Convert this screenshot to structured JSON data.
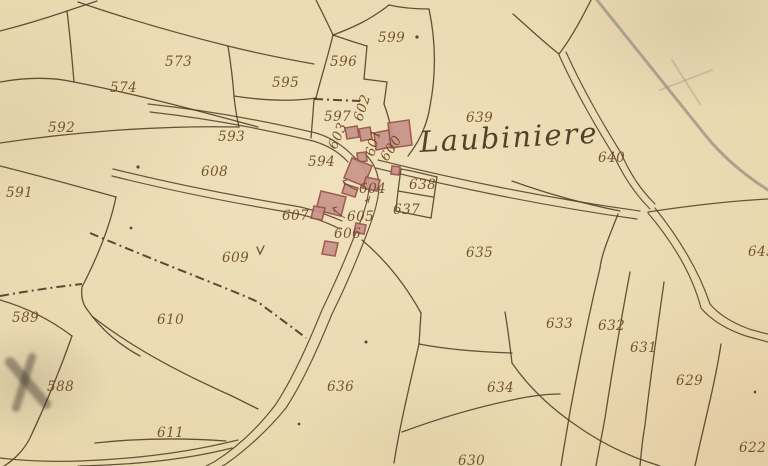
{
  "map": {
    "place_name": "Laubiniere",
    "place_label": {
      "x": 420,
      "y": 152,
      "rot": -3
    },
    "parcel_labels": [
      {
        "text": "573",
        "x": 165,
        "y": 66,
        "rot": 0
      },
      {
        "text": "574",
        "x": 110,
        "y": 92,
        "rot": 0
      },
      {
        "text": "592",
        "x": 48,
        "y": 132,
        "rot": 0
      },
      {
        "text": "593",
        "x": 218,
        "y": 141,
        "rot": 0
      },
      {
        "text": "591",
        "x": 6,
        "y": 197,
        "rot": 0
      },
      {
        "text": "595",
        "x": 272,
        "y": 87,
        "rot": 0
      },
      {
        "text": "596",
        "x": 330,
        "y": 66,
        "rot": 0
      },
      {
        "text": "599",
        "x": 378,
        "y": 42,
        "rot": 0
      },
      {
        "text": "597",
        "x": 324,
        "y": 121,
        "rot": 0
      },
      {
        "text": "639",
        "x": 466,
        "y": 122,
        "rot": 0
      },
      {
        "text": "640",
        "x": 598,
        "y": 162,
        "rot": 0
      },
      {
        "text": "608",
        "x": 201,
        "y": 176,
        "rot": 0
      },
      {
        "text": "594",
        "x": 308,
        "y": 166,
        "rot": 0
      },
      {
        "text": "602",
        "x": 362,
        "y": 122,
        "rot": -72
      },
      {
        "text": "603",
        "x": 336,
        "y": 150,
        "rot": -66
      },
      {
        "text": "601",
        "x": 374,
        "y": 157,
        "rot": -75
      },
      {
        "text": "600",
        "x": 387,
        "y": 162,
        "rot": -56
      },
      {
        "text": "604",
        "x": 359,
        "y": 193,
        "rot": 0
      },
      {
        "text": "638",
        "x": 409,
        "y": 189,
        "rot": 0
      },
      {
        "text": "607",
        "x": 282,
        "y": 220,
        "rot": 0
      },
      {
        "text": "605",
        "x": 347,
        "y": 221,
        "rot": 0
      },
      {
        "text": "637",
        "x": 393,
        "y": 214,
        "rot": 0
      },
      {
        "text": "606",
        "x": 334,
        "y": 238,
        "rot": 0
      },
      {
        "text": "609",
        "x": 222,
        "y": 262,
        "rot": 0
      },
      {
        "text": "635",
        "x": 466,
        "y": 257,
        "rot": 0
      },
      {
        "text": "645",
        "x": 748,
        "y": 256,
        "rot": 0
      },
      {
        "text": "589",
        "x": 12,
        "y": 322,
        "rot": 0
      },
      {
        "text": "610",
        "x": 157,
        "y": 324,
        "rot": 0
      },
      {
        "text": "633",
        "x": 546,
        "y": 328,
        "rot": 0
      },
      {
        "text": "632",
        "x": 598,
        "y": 330,
        "rot": 0
      },
      {
        "text": "631",
        "x": 630,
        "y": 352,
        "rot": 0
      },
      {
        "text": "588",
        "x": 47,
        "y": 391,
        "rot": 0
      },
      {
        "text": "636",
        "x": 327,
        "y": 391,
        "rot": 0
      },
      {
        "text": "634",
        "x": 487,
        "y": 392,
        "rot": 0
      },
      {
        "text": "629",
        "x": 676,
        "y": 385,
        "rot": 0
      },
      {
        "text": "611",
        "x": 157,
        "y": 437,
        "rot": 0
      },
      {
        "text": "622",
        "x": 739,
        "y": 452,
        "rot": 0
      },
      {
        "text": "630",
        "x": 458,
        "y": 465,
        "rot": 0
      }
    ],
    "colors": {
      "parchment": "#e9d7ae",
      "ink": "#4f3d26",
      "label_ink": "#6b4a22",
      "building_fill": "#c9958c",
      "building_stroke": "#9a544b",
      "pencil_gray": "#8d8679"
    }
  }
}
